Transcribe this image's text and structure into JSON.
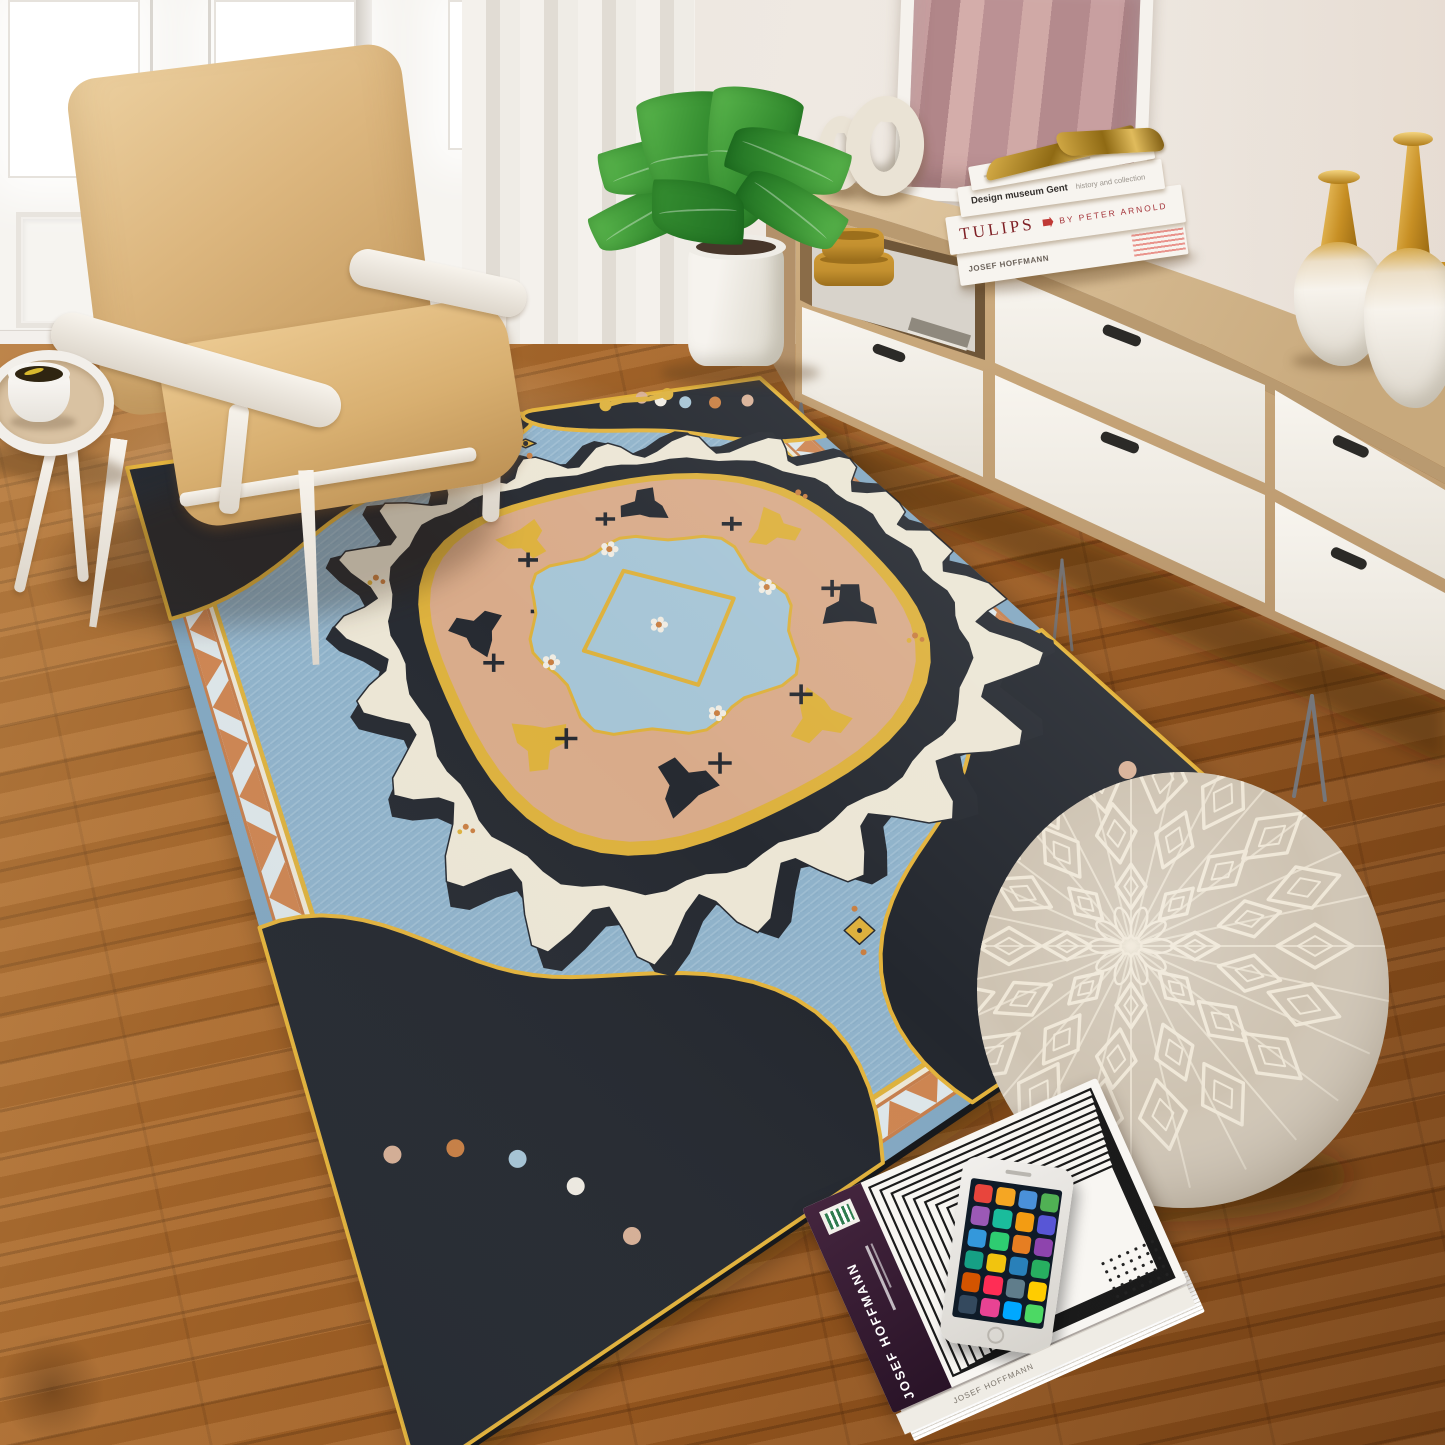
{
  "scene": {
    "width": 1445,
    "height": 1445
  },
  "palette": {
    "doorWhite": "#f6f4f0",
    "floorBase": "#9c5a20",
    "chairTanLight": "#ecd0a0",
    "chairTan": "#dcb67e",
    "chairTanDark": "#c1965a",
    "tableTray": "#d9c2a2",
    "coffee": "#2f2511",
    "coffeeGlint": "#d8b92e",
    "plantLight": "#5cb84e",
    "plant": "#368f31",
    "plantDark": "#1f6f22",
    "woodTopLight": "#e3cba6",
    "woodTop": "#cbad80",
    "woodFace": "#c9a87a",
    "woodSide": "#b3916a",
    "drawer": "#f5f1eb",
    "handle": "#2b2a27",
    "legMetal": "#75767a",
    "mirrorFrame": "#f5f2ed",
    "mirrorPinkA": "#c89fa0",
    "mirrorPinkB": "#b18689",
    "mirrorPinkC": "#d4adaa",
    "mustard": "#c3902f",
    "mustardDark": "#9c6f1c",
    "donut": "#eae3d5",
    "vaseWhite": "#f4f0e9",
    "gold": "#d8a844",
    "bookWhite": "#f7f4ef",
    "maroon": "#7e1f24",
    "redAccent": "#c03a36",
    "inkDark": "#332f2c",
    "inkSoft": "#9a948c",
    "plum": "#44253e",
    "plumDark": "#291327",
    "poufBase": "#cec3b2",
    "poufCream": "#efe7d7",
    "phoneScreen": "#0f1b28"
  },
  "rug": {
    "corners": {
      "W": [
        127,
        468
      ],
      "N": [
        760,
        378
      ],
      "E": [
        1312,
        872
      ],
      "S": [
        418,
        1478
      ]
    },
    "warp": {
      "uExp": 1.0,
      "vExp": 1.7,
      "vScale": 0.625
    },
    "colors": {
      "field": "#8fb2ca",
      "edgeBand": "#82a7c1",
      "orangeLine": "#c57e4c",
      "bandBg": "#dde6e9",
      "zig": "#cd8450",
      "yellow": "#ddb13d",
      "spandrel": "#23272e",
      "outline": "#e3b33c",
      "black": "#262a31",
      "scallop": "#ece6d5",
      "peach": "#d9ab8a",
      "innerBlue": "#a6c5d6",
      "orange": "#c97f42",
      "pink": "#d8b096",
      "white": "#f0ece2",
      "fleck": "#c9dbe6",
      "underEdge": "#17191c"
    },
    "rings": [
      {
        "i": 0.0,
        "c": "edgeBand"
      },
      {
        "i": 0.018,
        "c": "orangeLine"
      },
      {
        "i": 0.022,
        "c": "bandBg"
      },
      {
        "i": 0.054,
        "c": "orangeLine"
      },
      {
        "i": 0.058,
        "c": "scallop"
      },
      {
        "i": 0.064,
        "c": "yellow"
      },
      {
        "i": 0.07,
        "c": "field"
      }
    ],
    "zig": {
      "outer": 0.022,
      "inner": 0.054,
      "nLong": 26,
      "nShort": 22
    },
    "spandrels": [
      {
        "cu": 0,
        "cv": 0,
        "du": 1,
        "dv": 1,
        "eu": 0.6,
        "ev": 0.3
      },
      {
        "cu": 1,
        "cv": 0,
        "du": -1,
        "dv": 1,
        "eu": 0.36,
        "ev": 0.26
      },
      {
        "cu": 1,
        "cv": 1,
        "du": -1,
        "dv": -1,
        "eu": 0.38,
        "ev": 0.3
      },
      {
        "cu": 0,
        "cv": 1,
        "du": 1,
        "dv": -1,
        "eu": 0.52,
        "ev": 0.34
      }
    ],
    "medallion": {
      "cu": 0.62,
      "cv": 0.5,
      "scallop": [
        0.4,
        0.3
      ],
      "black": [
        0.352,
        0.264
      ],
      "yellowRing": [
        0.312,
        0.234
      ],
      "peach": [
        0.296,
        0.222
      ],
      "motifRing": [
        0.235,
        0.176
      ],
      "innerBlue": [
        0.165,
        0.124
      ],
      "diamond": [
        0.105,
        0.079
      ]
    },
    "crosses": [
      [
        0.17,
        -0.1
      ],
      [
        -0.18,
        0.08
      ],
      [
        0.1,
        0.13
      ],
      [
        -0.11,
        -0.13
      ],
      [
        0.22,
        0.03
      ],
      [
        -0.22,
        -0.02
      ],
      [
        0.02,
        -0.16
      ],
      [
        -0.03,
        0.16
      ],
      [
        0.13,
        0.05
      ],
      [
        -0.13,
        -0.06
      ],
      [
        0.05,
        0.1
      ],
      [
        -0.06,
        -0.1
      ]
    ],
    "pendants": [
      [
        0.6,
        0.155
      ],
      [
        0.62,
        0.845
      ]
    ],
    "sprigs": [
      [
        0.3,
        0.34
      ],
      [
        0.88,
        0.62
      ],
      [
        0.28,
        0.62
      ],
      [
        0.9,
        0.38
      ]
    ],
    "scroll": [
      0.8,
      0.045
    ]
  },
  "pouf": {
    "cx": 1183,
    "cy": 990,
    "rx": 206,
    "ry": 218,
    "patternOffset": [
      -52,
      -44
    ],
    "rays": 28,
    "rings": [
      {
        "r": 64,
        "n": 8,
        "s": 24
      },
      {
        "r": 122,
        "n": 13,
        "s": 32
      },
      {
        "r": 184,
        "n": 18,
        "s": 38
      }
    ]
  },
  "books_stack": {
    "book2_title": "Design museum Gent",
    "book2_subtitle": "history and collection",
    "book3_title": "TULIPS",
    "book3_author": "BY PETER ARNOLD",
    "book4_title": "JOSEF HOFFMANN"
  },
  "floor_book": {
    "band_title": "JOSEF HOFFMANN",
    "spine_title": "JOSEF HOFFMANN",
    "app_colors": [
      "#e8453c",
      "#f5a623",
      "#4a90d9",
      "#50b154",
      "#9b59b6",
      "#1abc9c",
      "#f39c12",
      "#5856d6",
      "#3498db",
      "#2ecc71",
      "#e67e22",
      "#8e44ad",
      "#16a085",
      "#f1c40f",
      "#2980b9",
      "#27ae60",
      "#d35400",
      "#ff2d55",
      "#607d8b",
      "#ffcc00",
      "#34495e",
      "#e84393",
      "#00a8ff",
      "#4cd964"
    ]
  }
}
